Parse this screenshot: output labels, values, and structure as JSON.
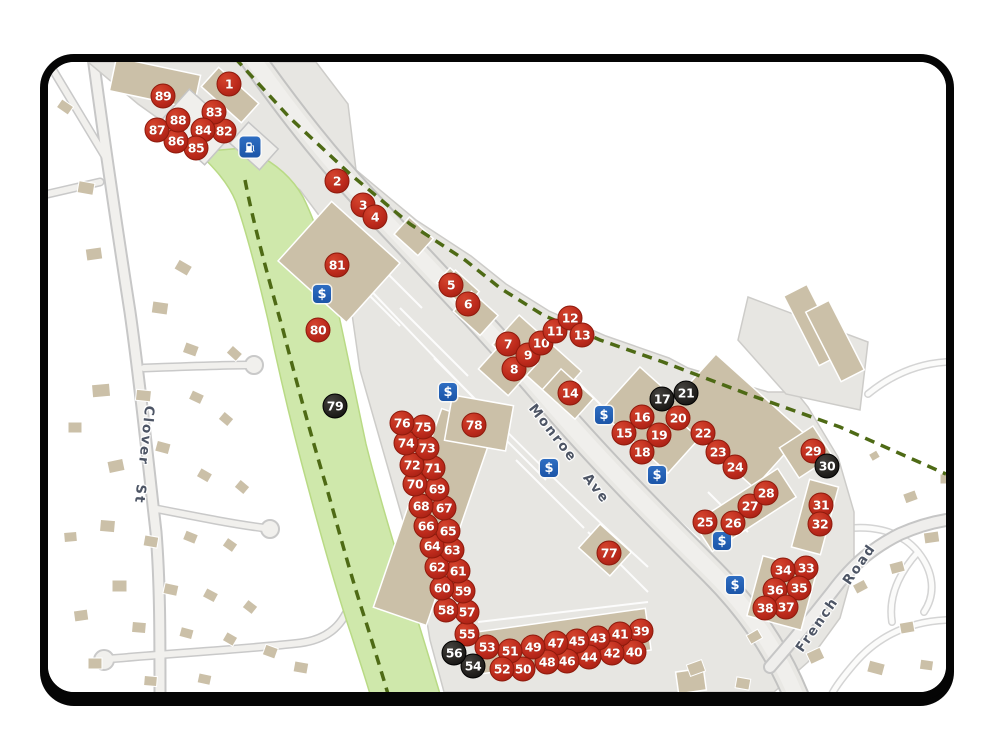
{
  "map": {
    "streets": {
      "clover": "Clover St",
      "monroe": "Monroe Ave",
      "french": "French Road"
    },
    "money_symbol": "$",
    "colors": {
      "marker_red": "#bd2a1c",
      "marker_black": "#23211e",
      "money_blue": "#1c55a8",
      "park_green": "#cfe8ab",
      "trail_green": "#4e6a15",
      "building_tan": "#cbc0a8",
      "road_gray": "#e9e8e4"
    },
    "markers": [
      {
        "n": "1",
        "type": "red",
        "x": 181,
        "y": 22
      },
      {
        "n": "2",
        "type": "red",
        "x": 289,
        "y": 119
      },
      {
        "n": "3",
        "type": "red",
        "x": 315,
        "y": 143
      },
      {
        "n": "4",
        "type": "red",
        "x": 327,
        "y": 155
      },
      {
        "n": "5",
        "type": "red",
        "x": 403,
        "y": 223
      },
      {
        "n": "6",
        "type": "red",
        "x": 420,
        "y": 242
      },
      {
        "n": "7",
        "type": "red",
        "x": 460,
        "y": 282
      },
      {
        "n": "8",
        "type": "red",
        "x": 466,
        "y": 307
      },
      {
        "n": "9",
        "type": "red",
        "x": 480,
        "y": 293
      },
      {
        "n": "10",
        "type": "red",
        "x": 493,
        "y": 281
      },
      {
        "n": "11",
        "type": "red",
        "x": 507,
        "y": 269
      },
      {
        "n": "12",
        "type": "red",
        "x": 522,
        "y": 256
      },
      {
        "n": "13",
        "type": "red",
        "x": 534,
        "y": 273
      },
      {
        "n": "14",
        "type": "red",
        "x": 522,
        "y": 331
      },
      {
        "n": "15",
        "type": "red",
        "x": 576,
        "y": 371
      },
      {
        "n": "16",
        "type": "red",
        "x": 594,
        "y": 355
      },
      {
        "n": "17",
        "type": "black",
        "x": 614,
        "y": 337
      },
      {
        "n": "18",
        "type": "red",
        "x": 594,
        "y": 390
      },
      {
        "n": "19",
        "type": "red",
        "x": 611,
        "y": 373
      },
      {
        "n": "20",
        "type": "red",
        "x": 630,
        "y": 356
      },
      {
        "n": "21",
        "type": "black",
        "x": 638,
        "y": 331
      },
      {
        "n": "22",
        "type": "red",
        "x": 655,
        "y": 371
      },
      {
        "n": "23",
        "type": "red",
        "x": 670,
        "y": 390
      },
      {
        "n": "24",
        "type": "red",
        "x": 687,
        "y": 405
      },
      {
        "n": "25",
        "type": "red",
        "x": 657,
        "y": 460
      },
      {
        "n": "26",
        "type": "red",
        "x": 685,
        "y": 461
      },
      {
        "n": "27",
        "type": "red",
        "x": 702,
        "y": 444
      },
      {
        "n": "28",
        "type": "red",
        "x": 718,
        "y": 431
      },
      {
        "n": "29",
        "type": "red",
        "x": 765,
        "y": 389
      },
      {
        "n": "30",
        "type": "black",
        "x": 779,
        "y": 404
      },
      {
        "n": "31",
        "type": "red",
        "x": 773,
        "y": 443
      },
      {
        "n": "32",
        "type": "red",
        "x": 772,
        "y": 462
      },
      {
        "n": "33",
        "type": "red",
        "x": 758,
        "y": 506
      },
      {
        "n": "34",
        "type": "red",
        "x": 735,
        "y": 508
      },
      {
        "n": "35",
        "type": "red",
        "x": 751,
        "y": 526
      },
      {
        "n": "36",
        "type": "red",
        "x": 727,
        "y": 528
      },
      {
        "n": "37",
        "type": "red",
        "x": 738,
        "y": 545
      },
      {
        "n": "38",
        "type": "red",
        "x": 717,
        "y": 546
      },
      {
        "n": "39",
        "type": "red",
        "x": 593,
        "y": 569
      },
      {
        "n": "40",
        "type": "red",
        "x": 586,
        "y": 590
      },
      {
        "n": "41",
        "type": "red",
        "x": 572,
        "y": 572
      },
      {
        "n": "42",
        "type": "red",
        "x": 564,
        "y": 591
      },
      {
        "n": "43",
        "type": "red",
        "x": 550,
        "y": 576
      },
      {
        "n": "44",
        "type": "red",
        "x": 541,
        "y": 595
      },
      {
        "n": "45",
        "type": "red",
        "x": 529,
        "y": 579
      },
      {
        "n": "46",
        "type": "red",
        "x": 519,
        "y": 599
      },
      {
        "n": "47",
        "type": "red",
        "x": 508,
        "y": 581
      },
      {
        "n": "48",
        "type": "red",
        "x": 499,
        "y": 600
      },
      {
        "n": "49",
        "type": "red",
        "x": 485,
        "y": 585
      },
      {
        "n": "50",
        "type": "red",
        "x": 475,
        "y": 607
      },
      {
        "n": "51",
        "type": "red",
        "x": 462,
        "y": 589
      },
      {
        "n": "52",
        "type": "red",
        "x": 454,
        "y": 607
      },
      {
        "n": "53",
        "type": "red",
        "x": 439,
        "y": 585
      },
      {
        "n": "54",
        "type": "black",
        "x": 425,
        "y": 604
      },
      {
        "n": "55",
        "type": "red",
        "x": 419,
        "y": 572
      },
      {
        "n": "56",
        "type": "black",
        "x": 406,
        "y": 591
      },
      {
        "n": "57",
        "type": "red",
        "x": 419,
        "y": 550
      },
      {
        "n": "58",
        "type": "red",
        "x": 398,
        "y": 548
      },
      {
        "n": "59",
        "type": "red",
        "x": 415,
        "y": 529
      },
      {
        "n": "60",
        "type": "red",
        "x": 394,
        "y": 526
      },
      {
        "n": "61",
        "type": "red",
        "x": 410,
        "y": 509
      },
      {
        "n": "62",
        "type": "red",
        "x": 389,
        "y": 505
      },
      {
        "n": "63",
        "type": "red",
        "x": 404,
        "y": 488
      },
      {
        "n": "64",
        "type": "red",
        "x": 384,
        "y": 484
      },
      {
        "n": "65",
        "type": "red",
        "x": 400,
        "y": 469
      },
      {
        "n": "66",
        "type": "red",
        "x": 378,
        "y": 464
      },
      {
        "n": "67",
        "type": "red",
        "x": 396,
        "y": 446
      },
      {
        "n": "68",
        "type": "red",
        "x": 373,
        "y": 444
      },
      {
        "n": "69",
        "type": "red",
        "x": 389,
        "y": 427
      },
      {
        "n": "70",
        "type": "red",
        "x": 367,
        "y": 422
      },
      {
        "n": "71",
        "type": "red",
        "x": 385,
        "y": 406
      },
      {
        "n": "72",
        "type": "red",
        "x": 364,
        "y": 403
      },
      {
        "n": "73",
        "type": "red",
        "x": 379,
        "y": 386
      },
      {
        "n": "74",
        "type": "red",
        "x": 358,
        "y": 381
      },
      {
        "n": "75",
        "type": "red",
        "x": 375,
        "y": 365
      },
      {
        "n": "76",
        "type": "red",
        "x": 354,
        "y": 361
      },
      {
        "n": "77",
        "type": "red",
        "x": 561,
        "y": 491
      },
      {
        "n": "78",
        "type": "red",
        "x": 426,
        "y": 363
      },
      {
        "n": "79",
        "type": "black",
        "x": 287,
        "y": 344
      },
      {
        "n": "80",
        "type": "red",
        "x": 270,
        "y": 268
      },
      {
        "n": "81",
        "type": "red",
        "x": 289,
        "y": 203
      },
      {
        "n": "82",
        "type": "red",
        "x": 176,
        "y": 69
      },
      {
        "n": "83",
        "type": "red",
        "x": 166,
        "y": 50
      },
      {
        "n": "84",
        "type": "red",
        "x": 155,
        "y": 68
      },
      {
        "n": "85",
        "type": "red",
        "x": 148,
        "y": 86
      },
      {
        "n": "86",
        "type": "red",
        "x": 128,
        "y": 79
      },
      {
        "n": "87",
        "type": "red",
        "x": 109,
        "y": 68
      },
      {
        "n": "88",
        "type": "red",
        "x": 130,
        "y": 58
      },
      {
        "n": "89",
        "type": "red",
        "x": 115,
        "y": 34
      }
    ],
    "money_icons": [
      {
        "x": 274,
        "y": 232
      },
      {
        "x": 400,
        "y": 330
      },
      {
        "x": 556,
        "y": 353
      },
      {
        "x": 501,
        "y": 406
      },
      {
        "x": 609,
        "y": 413
      },
      {
        "x": 674,
        "y": 479
      },
      {
        "x": 687,
        "y": 523
      }
    ],
    "fuel_icon": {
      "x": 202,
      "y": 85
    }
  }
}
